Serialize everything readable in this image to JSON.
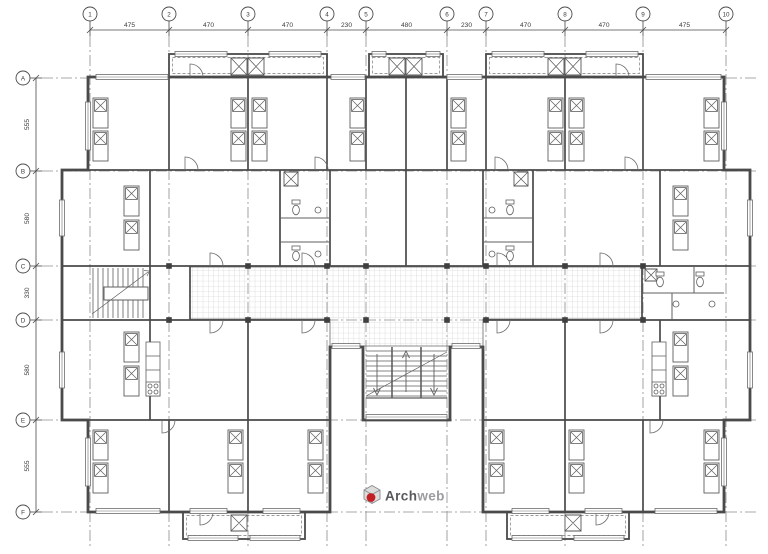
{
  "drawing": {
    "type": "architectural floor plan",
    "grid": {
      "columns": [
        "1",
        "2",
        "3",
        "4",
        "5",
        "6",
        "7",
        "8",
        "9",
        "10"
      ],
      "rows": [
        "A",
        "B",
        "C",
        "D",
        "E",
        "F"
      ]
    },
    "dimensions": {
      "top": [
        "475",
        "470",
        "470",
        "230",
        "480",
        "230",
        "470",
        "470",
        "475"
      ],
      "left": [
        "555",
        "580",
        "330",
        "580",
        "555"
      ]
    }
  },
  "logo": {
    "part1": "Arch",
    "part2": "web"
  },
  "colors": {
    "wall": "#4a4a4a",
    "line": "#5f5f5f",
    "grid_line": "#8c8c8c",
    "hatch": "#c6c6c6",
    "dimension_text": "#3c3c3c",
    "logo_red": "#c31f25",
    "logo_dark": "#58595c",
    "logo_light": "#9b9ca0",
    "background": "#ffffff"
  }
}
